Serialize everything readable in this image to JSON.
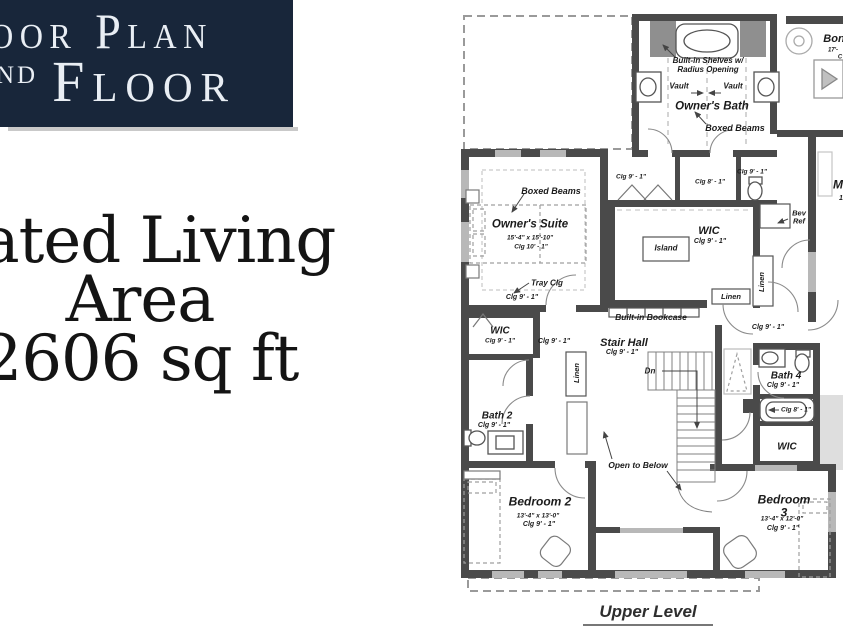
{
  "title_block": {
    "bg_color": "#18263a",
    "text_color": "#e9eef4",
    "line1": "oor Plan",
    "line2_prefix": "nd",
    "line2_main": "Floor"
  },
  "heading": {
    "color": "#141414",
    "lines": [
      "eated Living",
      "Area",
      "2606 sq ft"
    ]
  },
  "plan": {
    "caption": "Upper Level",
    "labels": [
      {
        "name": "label-built-in-shelves",
        "text": "Built-in Shelves w/\nRadius Opening",
        "x": 708,
        "y": 66,
        "fs": 8
      },
      {
        "name": "label-vault-left",
        "text": "Vault",
        "x": 679,
        "y": 87,
        "fs": 8
      },
      {
        "name": "label-vault-right",
        "text": "Vault",
        "x": 733,
        "y": 87,
        "fs": 8
      },
      {
        "name": "label-owners-bath",
        "text": "Owner's Bath",
        "x": 712,
        "y": 107,
        "fs": 11.5
      },
      {
        "name": "label-boxed-beams-bath",
        "text": "Boxed Beams",
        "x": 735,
        "y": 128,
        "fs": 9
      },
      {
        "name": "label-clg-closet",
        "text": "Clg 9' - 1\"",
        "x": 631,
        "y": 177,
        "fs": 6.5
      },
      {
        "name": "label-clg-shower",
        "text": "Clg 8' - 1\"",
        "x": 710,
        "y": 182,
        "fs": 6.5
      },
      {
        "name": "label-clg-wc",
        "text": "Clg 9' - 1\"",
        "x": 752,
        "y": 172,
        "fs": 6.5
      },
      {
        "name": "label-boxed-beams-suite",
        "text": "Boxed Beams",
        "x": 551,
        "y": 191,
        "fs": 9
      },
      {
        "name": "label-owners-suite",
        "text": "Owner's Suite",
        "x": 530,
        "y": 225,
        "fs": 11.5
      },
      {
        "name": "label-owners-suite-dims",
        "text": "15'-4\" x 15'-10\"",
        "x": 530,
        "y": 238,
        "fs": 6.5
      },
      {
        "name": "label-owners-suite-clg",
        "text": "Clg 10' - 1\"",
        "x": 531,
        "y": 247,
        "fs": 6.5
      },
      {
        "name": "label-tray-clg",
        "text": "Tray Clg",
        "x": 547,
        "y": 284,
        "fs": 8
      },
      {
        "name": "label-suite-clg9",
        "text": "Clg 9' - 1\"",
        "x": 522,
        "y": 298,
        "fs": 7
      },
      {
        "name": "label-wic-main",
        "text": "WIC",
        "x": 709,
        "y": 231,
        "fs": 11
      },
      {
        "name": "label-wic-main-clg",
        "text": "Clg 9' - 1\"",
        "x": 710,
        "y": 242,
        "fs": 7
      },
      {
        "name": "label-island",
        "text": "Island",
        "x": 666,
        "y": 249,
        "fs": 8
      },
      {
        "name": "label-bev-ref",
        "text": "Bev\nRef",
        "x": 799,
        "y": 218,
        "fs": 7.5
      },
      {
        "name": "label-linen-vertical-right",
        "text": "Linen",
        "x": 762,
        "y": 282,
        "fs": 7.5,
        "rot": -90
      },
      {
        "name": "label-linen-horizontal",
        "text": "Linen",
        "x": 731,
        "y": 297,
        "fs": 7.5
      },
      {
        "name": "label-built-in-bookcase",
        "text": "Built-in Bookcase",
        "x": 651,
        "y": 318,
        "fs": 8.5
      },
      {
        "name": "label-clg-hall-right",
        "text": "Clg 9' - 1\"",
        "x": 768,
        "y": 328,
        "fs": 7
      },
      {
        "name": "label-stair-hall",
        "text": "Stair Hall",
        "x": 624,
        "y": 343,
        "fs": 11
      },
      {
        "name": "label-stair-hall-clg",
        "text": "Clg 9' - 1\"",
        "x": 622,
        "y": 353,
        "fs": 7
      },
      {
        "name": "label-dn",
        "text": "Dn",
        "x": 650,
        "y": 372,
        "fs": 8
      },
      {
        "name": "label-open-to-below",
        "text": "Open to Below",
        "x": 638,
        "y": 466,
        "fs": 8.5
      },
      {
        "name": "label-clg-hall-left",
        "text": "Clg 9' - 1\"",
        "x": 554,
        "y": 342,
        "fs": 7
      },
      {
        "name": "label-linen-vertical-left",
        "text": "Linen",
        "x": 577,
        "y": 373,
        "fs": 7.5,
        "rot": -90
      },
      {
        "name": "label-wic-left",
        "text": "WIC",
        "x": 500,
        "y": 331,
        "fs": 10
      },
      {
        "name": "label-wic-left-clg",
        "text": "Clg 9' - 1\"",
        "x": 500,
        "y": 341,
        "fs": 6.5
      },
      {
        "name": "label-bath2",
        "text": "Bath 2",
        "x": 497,
        "y": 416,
        "fs": 10
      },
      {
        "name": "label-bath2-clg",
        "text": "Clg 9' - 1\"",
        "x": 494,
        "y": 426,
        "fs": 7
      },
      {
        "name": "label-bedroom2",
        "text": "Bedroom 2",
        "x": 540,
        "y": 502,
        "fs": 12
      },
      {
        "name": "label-bedroom2-dims",
        "text": "13'-4\" x 13'-0\"",
        "x": 538,
        "y": 516,
        "fs": 6.5
      },
      {
        "name": "label-bedroom2-clg",
        "text": "Clg 9' - 1\"",
        "x": 539,
        "y": 525,
        "fs": 7
      },
      {
        "name": "label-bedroom3",
        "text": "Bedroom 3",
        "x": 784,
        "y": 507,
        "fs": 12
      },
      {
        "name": "label-bedroom3-dims",
        "text": "13'-4\" x 12'-0\"",
        "x": 782,
        "y": 519,
        "fs": 6.5
      },
      {
        "name": "label-bedroom3-clg",
        "text": "Clg 9' - 1\"",
        "x": 783,
        "y": 529,
        "fs": 7
      },
      {
        "name": "label-bath4",
        "text": "Bath 4",
        "x": 786,
        "y": 376,
        "fs": 10
      },
      {
        "name": "label-bath4-clg",
        "text": "Clg 9' - 1\"",
        "x": 783,
        "y": 386,
        "fs": 7
      },
      {
        "name": "label-tub-clg",
        "text": "Clg 8' - 1\"",
        "x": 796,
        "y": 410,
        "fs": 6.5
      },
      {
        "name": "label-wic-bath4",
        "text": "WIC",
        "x": 787,
        "y": 447,
        "fs": 10
      },
      {
        "name": "label-bonus-partial",
        "text": "Bon",
        "x": 834,
        "y": 39,
        "fs": 11
      },
      {
        "name": "label-bonus-dim-partial",
        "text": "17'-",
        "x": 833,
        "y": 51,
        "fs": 6
      },
      {
        "name": "label-bonus-clg-partial",
        "text": "C",
        "x": 840,
        "y": 58,
        "fs": 6
      },
      {
        "name": "label-room-m-partial",
        "text": "M",
        "x": 838,
        "y": 185,
        "fs": 12
      },
      {
        "name": "label-room-m-dim-partial",
        "text": "1",
        "x": 841,
        "y": 199,
        "fs": 7
      }
    ]
  }
}
